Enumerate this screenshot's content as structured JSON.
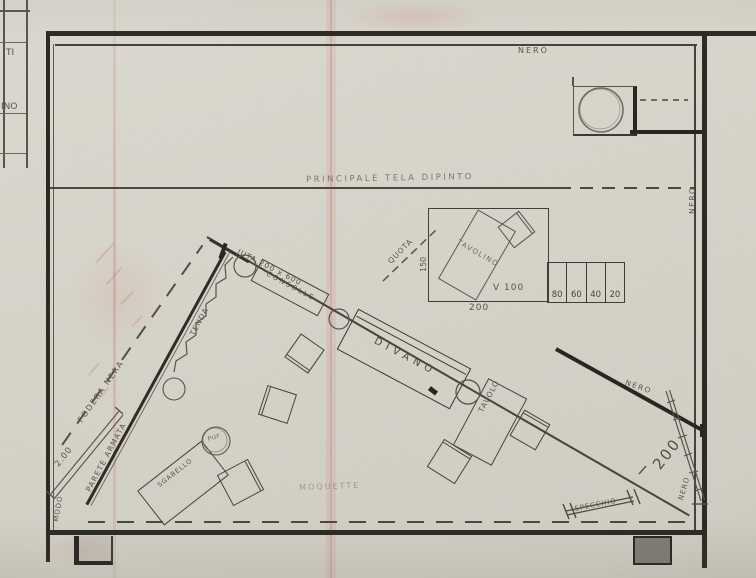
{
  "drawing": {
    "title_block": {
      "rows": [
        "TI",
        "INO"
      ]
    },
    "room": {
      "top_wall_label": "NERO",
      "right_wall_label": "NERO"
    },
    "backdrop": {
      "main_canvas": "PRINCIPALE TELA DIPINTO",
      "nero_diagonal": "NERO",
      "nero_corner": "NERO",
      "width_200": "200"
    },
    "platform_detail": {
      "tavolino": "TAVOLINO",
      "quota": "QUOTA",
      "height_150": "150",
      "width_200": "200",
      "level_v100": "V 100",
      "steps": [
        "80",
        "60",
        "40",
        "20"
      ]
    },
    "stage": {
      "juta": "JUTA 200 x 600",
      "consolle": "CONSOLLE",
      "divano": "DIVANO",
      "tavolo": "TAVOLO",
      "tenda": "TENDA",
      "fodera_nera": "FODERA NERA",
      "parete_armata": "PARETE ARMATA",
      "dim_2_00": "2.00",
      "modo": "MODO",
      "sgabello": "SGABELLO",
      "puf": "PUF",
      "specchio": "SPECCHIO",
      "moquette": "MOQUETTE"
    }
  }
}
